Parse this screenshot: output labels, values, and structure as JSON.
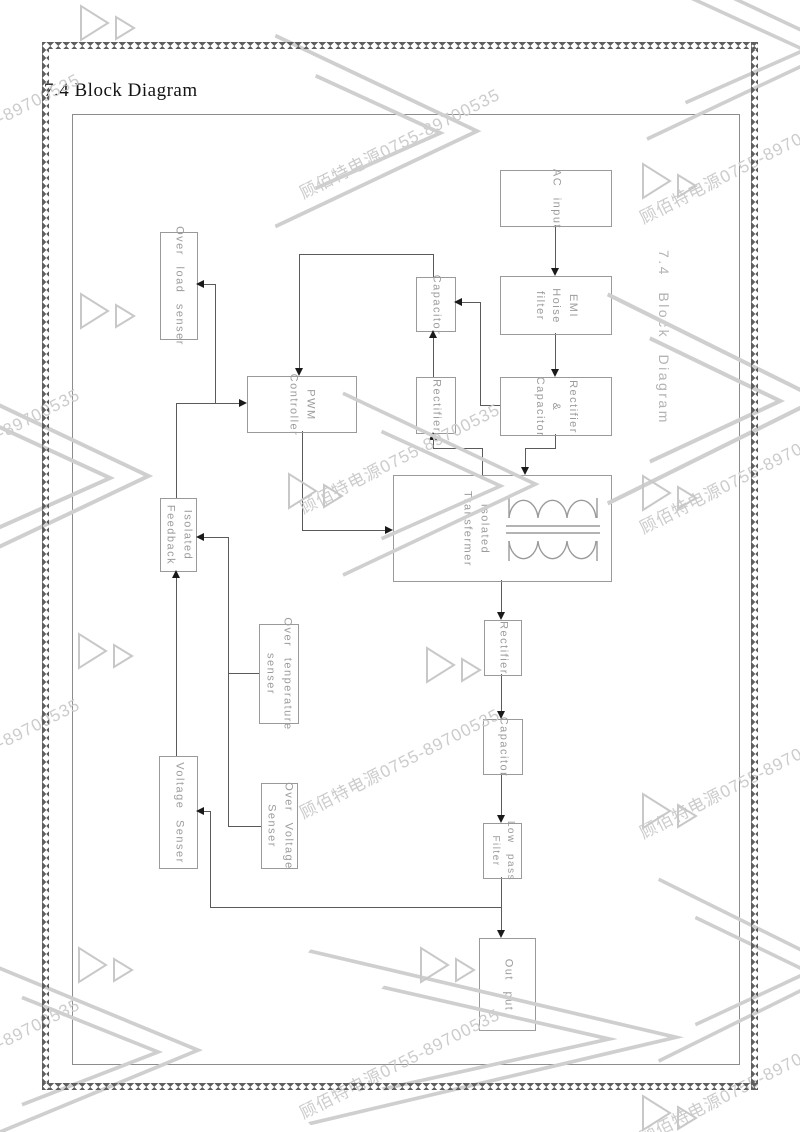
{
  "page": {
    "title": "7.4 Block Diagram",
    "side_title": "7.4 Block Diagram"
  },
  "watermark": {
    "text": "顾佰特电源0755-89700535",
    "color": "#cccccc"
  },
  "colors": {
    "connector_line": "#5a5a5a",
    "arrow_head": "#1a1a1a",
    "box_border": "#9a9a9a",
    "box_label": "#9c9c9c",
    "frame_border": "#8c8c8c",
    "zigzag_border": "#5f5f5f",
    "watermark_gray": "#cccccc"
  },
  "diagram": {
    "blocks": {
      "ac_input": {
        "label": "AC input"
      },
      "emi_filter": {
        "label": "EMI\nHoise\nfilter"
      },
      "rectifier_capacitor": {
        "label": "Rectifier\n&\nCapacitor"
      },
      "capacitor_aux": {
        "label": "Capacitor"
      },
      "rectifier_aux": {
        "label": "Rectifier"
      },
      "pwm_controller": {
        "label": "PWM\nController"
      },
      "over_load_senser": {
        "label": "Over load senser"
      },
      "isolated_feedback": {
        "label": "Isolated\nFeedback"
      },
      "isolated_transformer": {
        "label": "Isolated\nTransfermer"
      },
      "rectifier_out": {
        "label": "Rectifier"
      },
      "capacitor_out": {
        "label": "Capacitor"
      },
      "low_pass_filter": {
        "label": "Low pass\nFilter"
      },
      "output": {
        "label": "Out put"
      },
      "voltage_senser": {
        "label": "Voltage Senser"
      },
      "over_voltage_senser": {
        "label": "Over Voltage\nSenser"
      },
      "over_temperature_senser": {
        "label": "Over tenperature\nsenser"
      }
    }
  }
}
